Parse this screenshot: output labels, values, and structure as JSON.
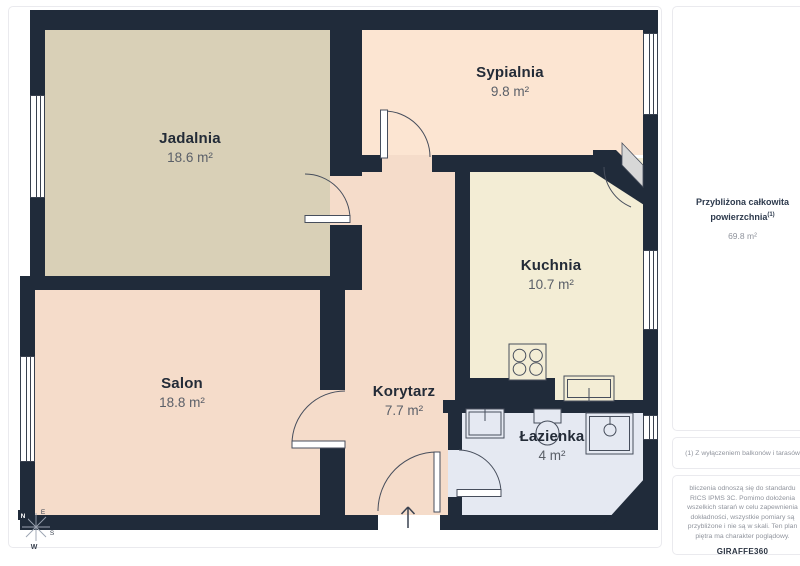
{
  "plan": {
    "rooms": [
      {
        "name": "Jadalnia",
        "area": "18.6 m²"
      },
      {
        "name": "Sypialnia",
        "area": "9.8 m²"
      },
      {
        "name": "Kuchnia",
        "area": "10.7 m²"
      },
      {
        "name": "Salon",
        "area": "18.8 m²"
      },
      {
        "name": "Korytarz",
        "area": "7.7 m²"
      },
      {
        "name": "Łazienka",
        "area": "4 m²"
      }
    ],
    "compass": {
      "n": "N",
      "e": "E",
      "s": "S",
      "w": "W"
    },
    "colors": {
      "wall": "#202b3a",
      "jadalnia": "#d9d0b7",
      "sypialnia": "#fce5d2",
      "kuchnia": "#f3edd5",
      "salon": "#f5dcca",
      "korytarz": "#f5dcca",
      "lazienka": "#e5e9f2",
      "door_panel": "#d7d7d7"
    }
  },
  "sidebar": {
    "total_label": "Przybliżona całkowita powierzchnia",
    "total_footnote_marker": "(1)",
    "total_value": "69.8 m²",
    "footnote": "(1) Z wyłączeniem balkonów i tarasów",
    "disclaimer": "bliczenia odnoszą się do standardu RICS IPMS 3C. Pomimo dołożenia wszelkich starań w celu zapewnienia dokładności, wszystkie pomiary są przybliżone i nie są w skali. Ten plan piętra ma charakter poglądowy.",
    "brand": "GIRAFFE",
    "brand_number": "360"
  }
}
